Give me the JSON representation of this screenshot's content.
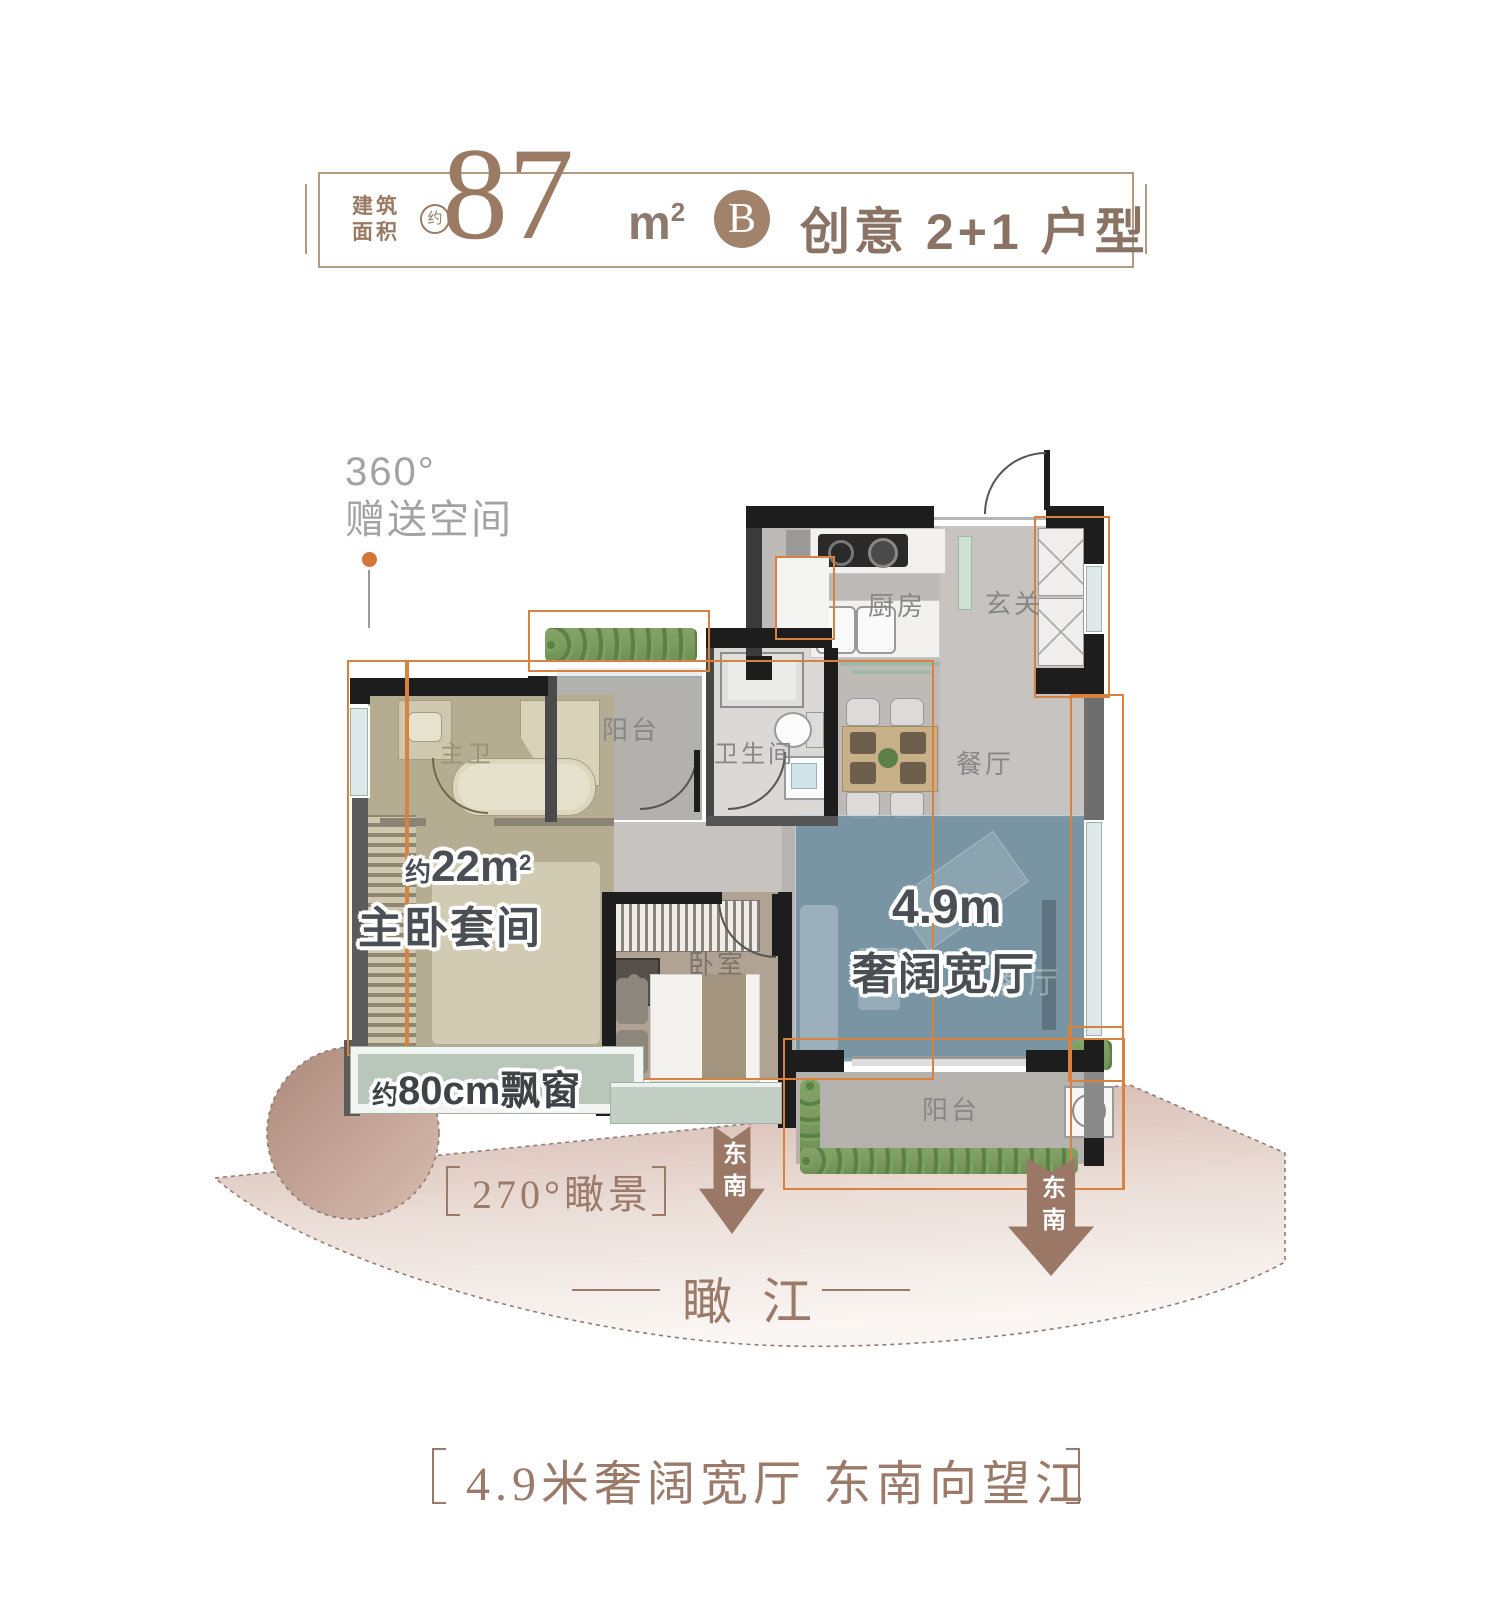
{
  "header": {
    "area_label_line1": "建筑",
    "area_label_line2": "面积",
    "approx_badge": "约",
    "area_number": "87",
    "area_unit": "m",
    "area_unit_sup": "2",
    "type_badge": "B",
    "type_title": "创意 2+1 户型"
  },
  "gift_note": {
    "line1": "360°",
    "line2": "赠送空间"
  },
  "rooms": {
    "kitchen": "厨房",
    "entry": "玄关",
    "balcony_top": "阳台",
    "bathroom": "卫生间",
    "dining": "餐厅",
    "master_bath": "主卫",
    "master_area_approx": "约",
    "master_area_value": "22m",
    "master_area_sup": "2",
    "master_name": "主卧套间",
    "bedroom": "卧室",
    "living_width": "4.9m",
    "living_name": "奢阔宽厅",
    "living_ghost": "客厅",
    "balcony_bottom": "阳台"
  },
  "bay_window": {
    "approx": "约",
    "text": "80cm飘窗"
  },
  "view_fan": {
    "label": "270°瞰景",
    "river_left": "瞰",
    "river_right": "江"
  },
  "arrows": {
    "a1": "东南",
    "a2": "东南"
  },
  "footer": {
    "caption": "4.9米奢阔宽厅  东南向望江"
  },
  "colors": {
    "accent_orange": "#d9813f",
    "brown": "#9b7a63",
    "badge_brown": "#a1826b",
    "highlight_blue": "#87a3b3",
    "highlight_khaki": "#b5ad92",
    "sage": "#b9c7bb"
  }
}
